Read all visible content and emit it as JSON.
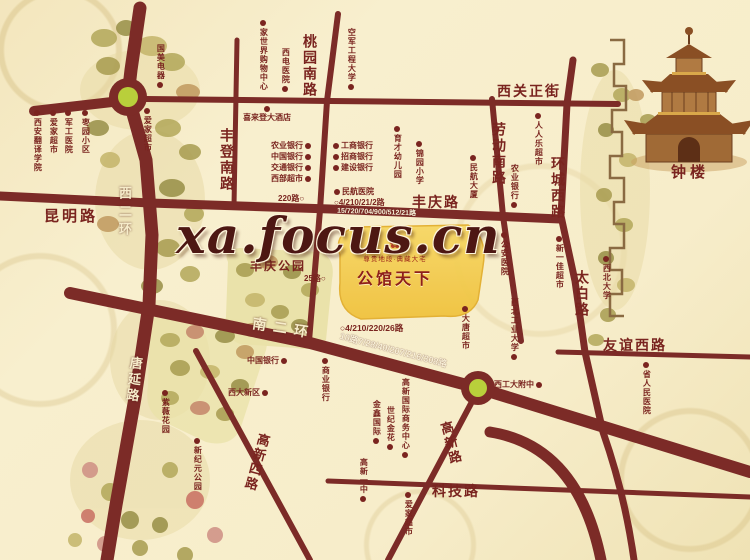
{
  "watermark": "xa.focus.cn",
  "project": {
    "name": "公馆天下",
    "tagline": "尊贵地段·典藏大宅",
    "ornament": "✿"
  },
  "colors": {
    "road": "#7c2b27",
    "label_dark": "#7a241f",
    "label_light": "#f6ecca",
    "project_area_gold": "#f4cf55",
    "roundabout_center": "#b9cf3b",
    "background": "#f7edcb"
  },
  "map": {
    "road_labels": [
      {
        "text": "昆明路",
        "x": 44,
        "y": 209,
        "o": "h",
        "s": 15,
        "ls": 3
      },
      {
        "text": "丰登南路",
        "x": 219,
        "y": 128,
        "o": "v",
        "s": 14,
        "ls": 2
      },
      {
        "text": "桃园南路",
        "x": 302,
        "y": 34,
        "o": "v",
        "s": 14,
        "ls": 2
      },
      {
        "text": "西关正街",
        "x": 497,
        "y": 85,
        "o": "h",
        "s": 14,
        "ls": 2
      },
      {
        "text": "劳动南路",
        "x": 491,
        "y": 122,
        "o": "v",
        "s": 14,
        "ls": 2
      },
      {
        "text": "环城西路",
        "x": 550,
        "y": 156,
        "o": "v",
        "s": 14,
        "ls": 2
      },
      {
        "text": "丰庆路",
        "x": 412,
        "y": 196,
        "o": "h",
        "s": 14,
        "ls": 2
      },
      {
        "text": "太白路",
        "x": 574,
        "y": 270,
        "o": "v",
        "s": 14,
        "ls": 2
      },
      {
        "text": "友谊西路",
        "x": 603,
        "y": 339,
        "o": "h",
        "s": 14,
        "ls": 2
      },
      {
        "text": "科技路",
        "x": 432,
        "y": 485,
        "o": "h",
        "s": 14,
        "ls": 2
      },
      {
        "text": "高新路",
        "x": 443,
        "y": 421,
        "o": "v",
        "s": 13,
        "ls": 2,
        "r": -15
      },
      {
        "text": "高新四路",
        "x": 249,
        "y": 432,
        "o": "v",
        "s": 13,
        "ls": 2,
        "r": 15
      },
      {
        "text": "钟楼",
        "x": 671,
        "y": 165,
        "o": "h",
        "s": 15,
        "ls": 4
      },
      {
        "text": "西二环",
        "x": 117,
        "y": 186,
        "o": "v",
        "s": 13,
        "c": "w",
        "ls": 5
      },
      {
        "text": "唐延路",
        "x": 126,
        "y": 356,
        "o": "v",
        "s": 13,
        "c": "w",
        "ls": 3,
        "r": 6
      },
      {
        "text": "南二环",
        "x": 252,
        "y": 322,
        "o": "h",
        "s": 14,
        "c": "w",
        "ls": 7,
        "r": 9
      }
    ],
    "bus_labels": [
      {
        "text": "220路○",
        "x": 278,
        "y": 195,
        "s": 8
      },
      {
        "text": "○4/210/21/2路",
        "x": 334,
        "y": 199,
        "s": 8
      },
      {
        "text": "15/720/704/900/512/21路",
        "x": 337,
        "y": 209,
        "s": 7,
        "c": "w",
        "r": 2
      },
      {
        "text": "25路○",
        "x": 304,
        "y": 275,
        "s": 8
      },
      {
        "text": "○4/210/220/26路",
        "x": 340,
        "y": 324,
        "s": 8.5
      },
      {
        "text": "10路7/28/40/207/216/308路",
        "x": 338,
        "y": 346,
        "s": 9,
        "c": "w",
        "r": 15
      }
    ],
    "pois": [
      {
        "text": "西安翻译学院",
        "x": 33,
        "y": 110,
        "o": "v",
        "dot": "t"
      },
      {
        "text": "爱家超市",
        "x": 49,
        "y": 110,
        "o": "v",
        "dot": "t"
      },
      {
        "text": "军工医院",
        "x": 64,
        "y": 110,
        "o": "v",
        "dot": "t"
      },
      {
        "text": "枣园小区",
        "x": 81,
        "y": 110,
        "o": "v",
        "dot": "t"
      },
      {
        "text": "国美电器",
        "x": 156,
        "y": 44,
        "o": "v",
        "dot": "b"
      },
      {
        "text": "爱家超市",
        "x": 143,
        "y": 108,
        "o": "v",
        "dot": "t"
      },
      {
        "text": "家世界购物中心",
        "x": 259,
        "y": 20,
        "o": "v",
        "dot": "t"
      },
      {
        "text": "西电医院",
        "x": 281,
        "y": 48,
        "o": "v",
        "dot": "b"
      },
      {
        "text": "空军工程大学",
        "x": 347,
        "y": 28,
        "o": "v",
        "dot": "b"
      },
      {
        "text": "喜来登大酒店",
        "x": 243,
        "y": 106,
        "o": "h",
        "dot": "t"
      },
      {
        "text": "人人乐超市",
        "x": 534,
        "y": 113,
        "o": "v",
        "dot": "t"
      },
      {
        "text": "民航大厦",
        "x": 469,
        "y": 155,
        "o": "v",
        "dot": "t"
      },
      {
        "text": "农业银行",
        "x": 510,
        "y": 164,
        "o": "v",
        "dot": "b"
      },
      {
        "text": "农业银行",
        "x": 271,
        "y": 142,
        "o": "h",
        "dot": "r"
      },
      {
        "text": "中国银行",
        "x": 271,
        "y": 153,
        "o": "h",
        "dot": "r"
      },
      {
        "text": "交通银行",
        "x": 271,
        "y": 164,
        "o": "h",
        "dot": "r"
      },
      {
        "text": "西部超市",
        "x": 271,
        "y": 175,
        "o": "h",
        "dot": "r"
      },
      {
        "text": "工商银行",
        "x": 333,
        "y": 142,
        "o": "h",
        "dot": "l"
      },
      {
        "text": "招商银行",
        "x": 333,
        "y": 153,
        "o": "h",
        "dot": "l"
      },
      {
        "text": "建设银行",
        "x": 333,
        "y": 164,
        "o": "h",
        "dot": "l"
      },
      {
        "text": "民航医院",
        "x": 334,
        "y": 188,
        "o": "h",
        "dot": "l"
      },
      {
        "text": "育才幼儿园",
        "x": 393,
        "y": 126,
        "o": "v",
        "dot": "t"
      },
      {
        "text": "锦园小学",
        "x": 415,
        "y": 141,
        "o": "v",
        "dot": "t"
      },
      {
        "text": "公安医院",
        "x": 500,
        "y": 232,
        "o": "v",
        "dot": "t"
      },
      {
        "text": "新一佳超市",
        "x": 555,
        "y": 236,
        "o": "v",
        "dot": "t"
      },
      {
        "text": "西北大学",
        "x": 602,
        "y": 256,
        "o": "v",
        "dot": "t"
      },
      {
        "text": "省人民医院",
        "x": 642,
        "y": 362,
        "o": "v",
        "dot": "t"
      },
      {
        "text": "大唐超市",
        "x": 461,
        "y": 306,
        "o": "v",
        "dot": "t"
      },
      {
        "text": "西北工业大学",
        "x": 510,
        "y": 298,
        "o": "v",
        "dot": "b"
      },
      {
        "text": "西工大附中",
        "x": 494,
        "y": 381,
        "o": "h",
        "dot": "r"
      },
      {
        "text": "中国银行",
        "x": 247,
        "y": 357,
        "o": "h",
        "dot": "r"
      },
      {
        "text": "西大新区",
        "x": 228,
        "y": 389,
        "o": "h",
        "dot": "r"
      },
      {
        "text": "商业银行",
        "x": 321,
        "y": 358,
        "o": "v",
        "dot": "t"
      },
      {
        "text": "紫薇花园",
        "x": 161,
        "y": 390,
        "o": "v",
        "dot": "t"
      },
      {
        "text": "新纪元公园",
        "x": 193,
        "y": 438,
        "o": "v",
        "dot": "t"
      },
      {
        "text": "金鑫国际",
        "x": 372,
        "y": 400,
        "o": "v",
        "dot": "b"
      },
      {
        "text": "世纪金花",
        "x": 386,
        "y": 406,
        "o": "v",
        "dot": "b"
      },
      {
        "text": "高新国际商务中心",
        "x": 401,
        "y": 378,
        "o": "v",
        "dot": "b"
      },
      {
        "text": "高新一中",
        "x": 359,
        "y": 458,
        "o": "v",
        "dot": "b"
      },
      {
        "text": "爱家超市",
        "x": 404,
        "y": 492,
        "o": "v",
        "dot": "t"
      },
      {
        "text": "丰庆公园",
        "x": 250,
        "y": 260,
        "o": "h",
        "dot": "n",
        "s": 12
      }
    ]
  }
}
